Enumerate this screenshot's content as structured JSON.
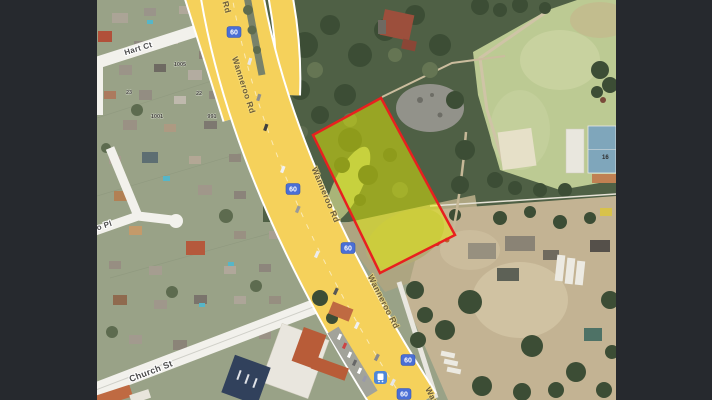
{
  "map": {
    "labels": {
      "road_name": "Wanneroo Rd",
      "road_name_top_partial": "Rd",
      "road_name_bottom_partial": "Wan",
      "hart_ct": "Hart Ct",
      "church_st": "Church St",
      "place_partial": "o Pl",
      "route_number": "60",
      "court_number": "16"
    },
    "house_numbers": [
      "1005",
      "1001",
      "991",
      "23",
      "22"
    ],
    "colors": {
      "letterbox": "#26292e",
      "road_yellow": "#f5d15b",
      "shield_blue": "#4a6fd6",
      "parcel_red": "#e8201f",
      "parcel_yellow": "#e8f000",
      "minor_road_white": "#f2f1ec",
      "field_green": "#bcca93",
      "bushland_green": "#4f6045",
      "yard_tan": "#c3b393",
      "suburb_green": "#99a287"
    }
  }
}
